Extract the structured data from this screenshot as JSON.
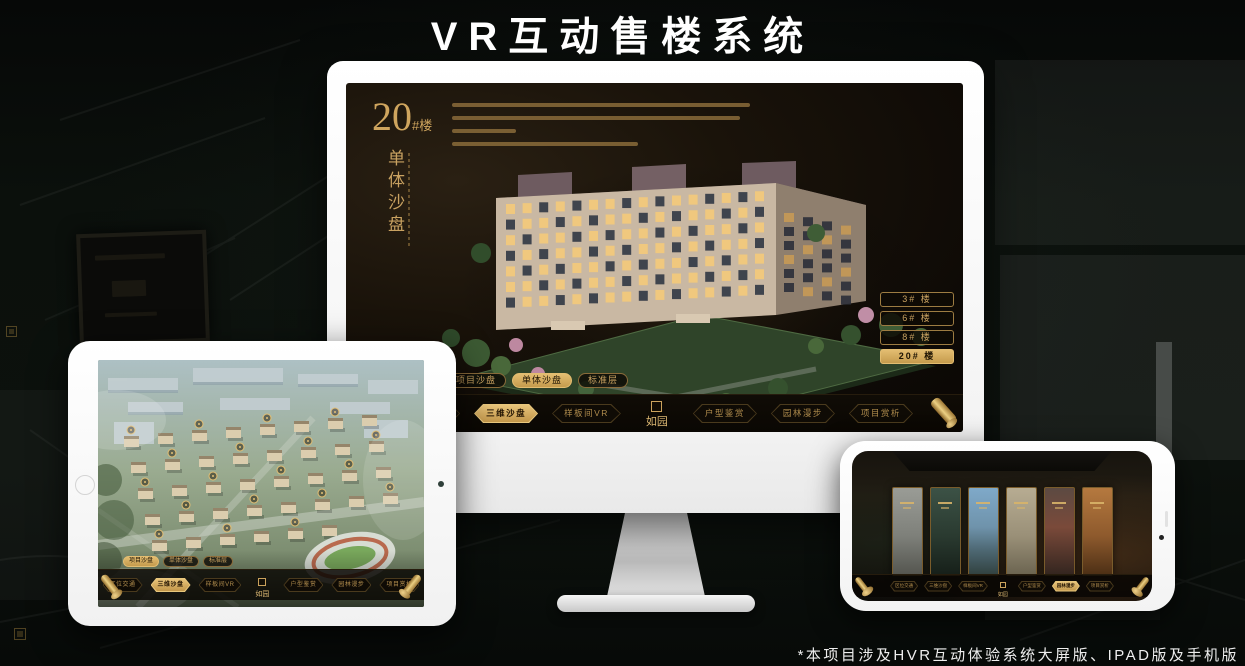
{
  "page": {
    "title": "VR互动售楼系统",
    "footnote": "*本项目涉及HVR互动体验系统大屏版、IPAD版及手机版"
  },
  "brand": {
    "logo": "如园"
  },
  "nav": {
    "tabs": [
      {
        "label": "项目沙盘"
      },
      {
        "label": "单体沙盘"
      },
      {
        "label": "标准层"
      }
    ],
    "items": [
      {
        "label": "区位交通"
      },
      {
        "label": "三维沙盘"
      },
      {
        "label": "样板间VR"
      },
      {
        "label": "户型鉴赏"
      },
      {
        "label": "园林漫步"
      },
      {
        "label": "项目赏析"
      }
    ]
  },
  "monitor": {
    "heading_number": "20",
    "heading_unit": "#楼",
    "vertical_title": "单体沙盘",
    "active_tab": "单体沙盘",
    "active_item": "三维沙盘",
    "floor_buttons": [
      {
        "label": "3# 楼"
      },
      {
        "label": "6# 楼"
      },
      {
        "label": "8# 楼"
      },
      {
        "label": "20# 楼"
      }
    ]
  },
  "ipad": {
    "active_tab": "项目沙盘",
    "active_item": "三维沙盘"
  },
  "phone": {
    "active_item": "园林漫步"
  },
  "colors": {
    "gold": "#c9a261",
    "gold_bright": "#e8c77d",
    "gold_active_bg": "#d9b269",
    "screen_brown": "#1a130a",
    "title_white": "#ffffff"
  }
}
